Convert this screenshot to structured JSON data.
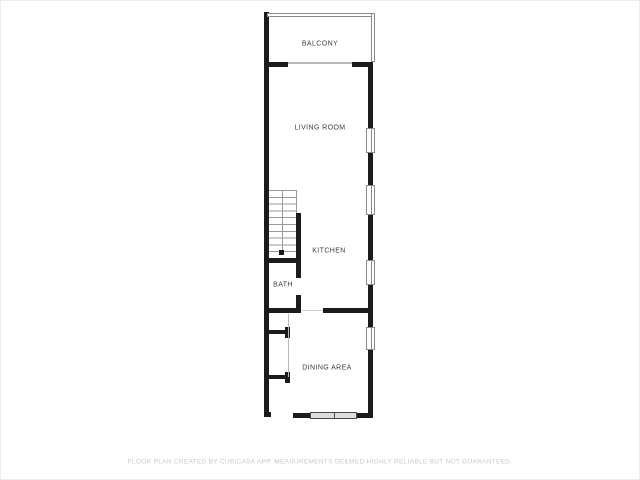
{
  "plan": {
    "rooms": [
      {
        "id": "balcony",
        "label": "BALCONY"
      },
      {
        "id": "living-room",
        "label": "LIVING ROOM"
      },
      {
        "id": "kitchen",
        "label": "KITCHEN"
      },
      {
        "id": "bath",
        "label": "BATH"
      },
      {
        "id": "dining-area",
        "label": "DINING AREA"
      }
    ],
    "features": {
      "staircase": true,
      "right_wall_window_count": 4,
      "balcony_railing": true,
      "bottom_wall_window_count": 1
    },
    "footer": "FLOOR PLAN CREATED BY CUBICASA APP. MEASUREMENTS DEEMED HIGHLY RELIABLE BUT NOT GUARANTEED.",
    "colors": {
      "wall": "#1b1b1b",
      "railing": "#8a8a8a",
      "window_border": "#8a8a8a",
      "window_fill": "#ffffff",
      "sliding_door_fill": "#dcdcdc",
      "label_text": "#3c3c3c",
      "footer_text": "#c9c9c9",
      "background": "#ffffff"
    }
  }
}
